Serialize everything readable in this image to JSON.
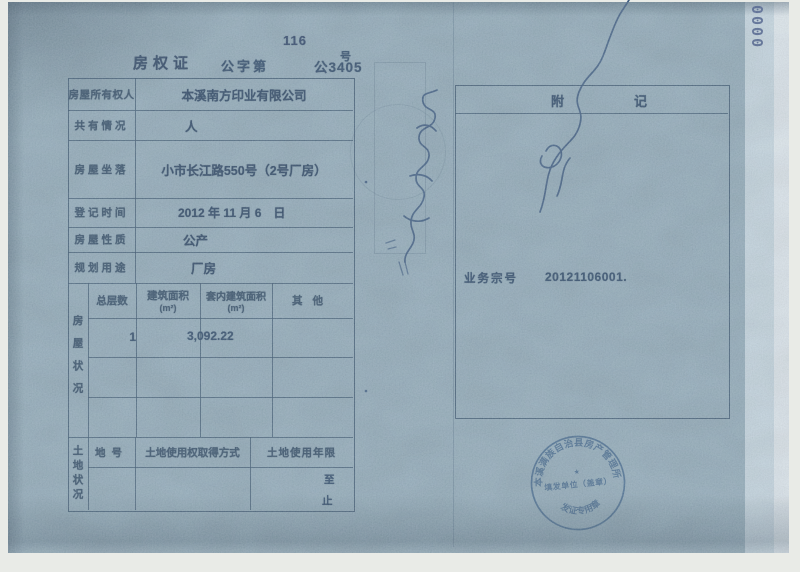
{
  "page": {
    "serial_number": "0000",
    "page_number": "116",
    "cert_label": "房权证",
    "cert_no_prefix": "公字第",
    "cert_no": "公3405",
    "cert_no_suffix": "号"
  },
  "fields": {
    "rows": [
      {
        "label": "房屋所有权人",
        "value": "本溪南方印业有限公司"
      },
      {
        "label": "共有情况",
        "value": "人"
      },
      {
        "label": "房屋坐落",
        "value": "小市长江路550号（2号厂房）"
      },
      {
        "label": "登记时间",
        "value": "2012 年 11 月 6　日"
      },
      {
        "label": "房屋性质",
        "value": "公产"
      },
      {
        "label": "规划用途",
        "value": "厂房"
      }
    ]
  },
  "house_status": {
    "side_label": "房屋状况",
    "col_total_floors": "总层数",
    "col_building_area": "建筑面积",
    "col_building_area_unit": "(m²)",
    "col_inner_area": "套内建筑面积",
    "col_inner_area_unit": "(m²)",
    "col_other": "其他",
    "total_floors_value": "1",
    "building_area_value": "3,092.22"
  },
  "land_status": {
    "side_label": "土地状况",
    "col_land_no": "地号",
    "col_acquisition": "土地使用权取得方式",
    "col_term": "土地使用年限",
    "term_from": "至",
    "term_to": "止"
  },
  "notes_panel": {
    "header": "附记",
    "case_label": "业务宗号",
    "case_number": "20121106001."
  },
  "stamp": {
    "arc_text": "本溪满族自治县房产管理所",
    "line_text": "填发单位（盖章）",
    "bottom_text": "发证专用章",
    "star": "★",
    "ink_color": "#2d567e"
  },
  "colors": {
    "paper": "#87a3b1",
    "ink": "#21405f",
    "scanner_bg": "#e9ebe7"
  }
}
